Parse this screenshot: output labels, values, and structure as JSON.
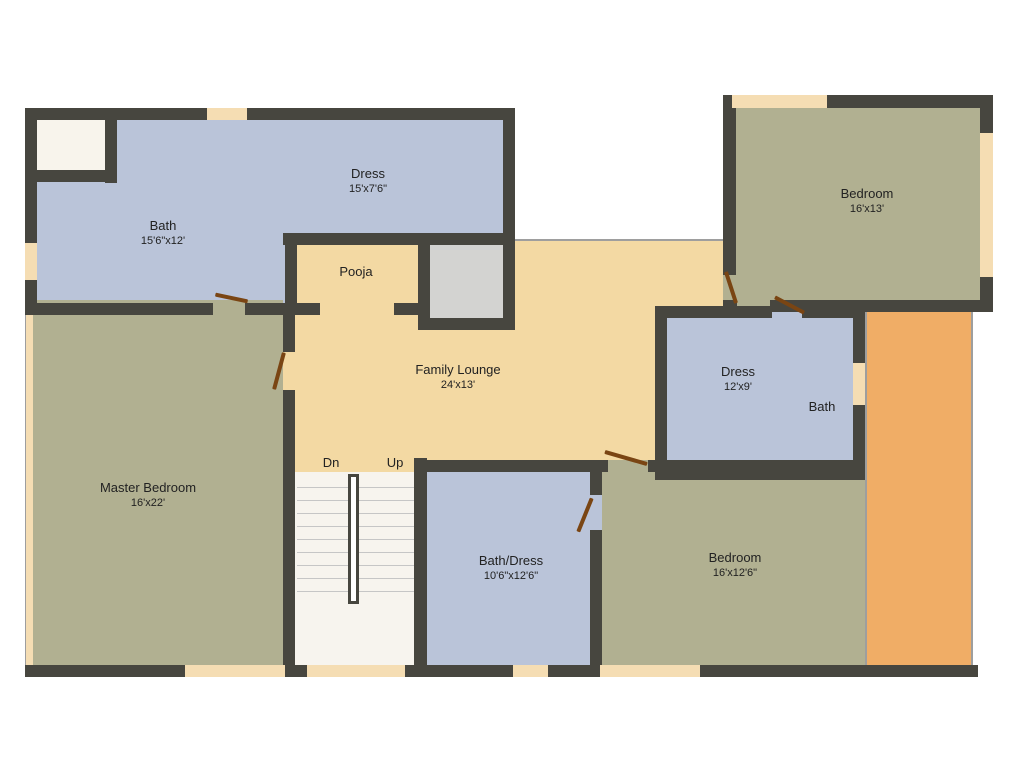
{
  "rooms": {
    "dress_top": {
      "name": "Dress",
      "dims": "15'x7'6\""
    },
    "bath_top": {
      "name": "Bath",
      "dims": "15'6\"x12'"
    },
    "pooja": {
      "name": "Pooja"
    },
    "bedroom_top_right": {
      "name": "Bedroom",
      "dims": "16'x13'"
    },
    "family_lounge": {
      "name": "Family Lounge",
      "dims": "24'x13'"
    },
    "dress_right": {
      "name": "Dress",
      "dims": "12'x9'"
    },
    "bath_right": {
      "name": "Bath"
    },
    "master_bedroom": {
      "name": "Master Bedroom",
      "dims": "16'x22'"
    },
    "bath_dress": {
      "name": "Bath/Dress",
      "dims": "10'6\"x12'6\""
    },
    "bedroom_bottom": {
      "name": "Bedroom",
      "dims": "16'x12'6\""
    }
  },
  "stairs": {
    "down": "Dn",
    "up": "Up"
  },
  "colors": {
    "wall": "#47463f",
    "room_blue": "#bac4d9",
    "room_sage": "#b1b091",
    "room_tan": "#f3d9a3",
    "balcony_orange": "#f0ad66",
    "store_gray": "#d3d3d1",
    "window": "#f5ddb3",
    "door": "#7a4513",
    "stair_white": "#f7f4ee"
  }
}
